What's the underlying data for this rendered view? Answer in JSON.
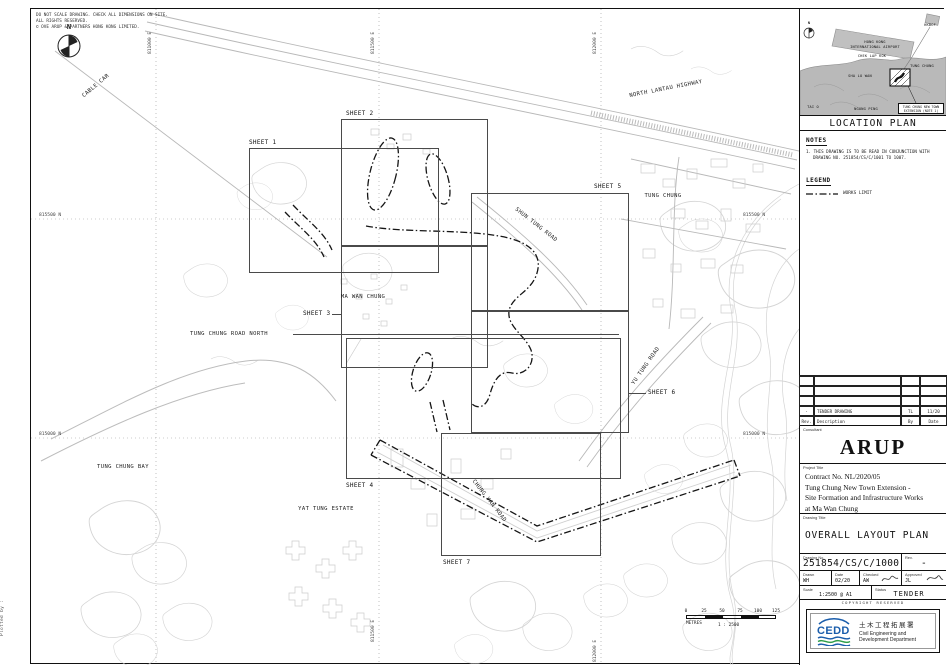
{
  "colors": {
    "cedd_blue": "#1a5dab",
    "cedd_green": "#2f9e49",
    "drawing_ink": "#1a1a1a",
    "contour_gray": "#d4d4d4"
  },
  "sheet_notes": {
    "disclaimer1": "DO NOT SCALE DRAWING. CHECK ALL DIMENSIONS ON SITE.",
    "disclaimer2": "ALL RIGHTS RESERVED.",
    "disclaimer3": "© OVE ARUP & PARTNERS HONG KONG LIMITED.",
    "plot_info": "Plotted by :"
  },
  "map": {
    "north": "N",
    "grid": {
      "e1": "811000 E",
      "e2": "811500 E",
      "e3": "812000 E",
      "n_top": "815500 N",
      "n_bottom": "815000 N"
    },
    "places": {
      "cable_car": "CABLE CAR",
      "north_lantau_highway": "NORTH LANTAU HIGHWAY",
      "tung_chung": "TUNG CHUNG",
      "shun_tung_road": "SHUN TUNG ROAD",
      "ma_wan_chung": "MA WAN CHUNG",
      "tung_chung_road_north": "TUNG CHUNG ROAD NORTH",
      "yu_tung_road": "YU TUNG ROAD",
      "tung_chung_bay": "TUNG CHUNG BAY",
      "yat_tung_estate": "YAT TUNG ESTATE",
      "chung_yan_road": "CHUNG YAN ROAD"
    },
    "sheets": {
      "s1": "SHEET 1",
      "s2": "SHEET 2",
      "s3": "SHEET 3",
      "s4": "SHEET 4",
      "s5": "SHEET 5",
      "s6": "SHEET 6",
      "s7": "SHEET 7"
    },
    "scalebar": {
      "t0": "0",
      "t1": "25",
      "t2": "50",
      "t3": "75",
      "t4": "100",
      "t5": "125",
      "unit": "METRES",
      "ratio": "1 : 2500"
    }
  },
  "location_plan": {
    "title": "LOCATION PLAN",
    "north": "N",
    "labels": {
      "airport1": "HONG KONG",
      "airport2": "INTERNATIONAL AIRPORT",
      "chek_lap_kok": "CHEK LAP KOK",
      "hkbcf": "HKBCF",
      "tung_chung": "TUNG CHUNG",
      "sha_lo_wan": "SHA LO WAN",
      "tai_o": "TAI O",
      "ngong_ping": "NGONG PING",
      "site1": "TUNG CHUNG NEW TOWN",
      "site2": "EXTENSION (NOTE 1)"
    }
  },
  "notes": {
    "heading": "NOTES",
    "line1": "1. THIS DRAWING IS TO BE READ IN CONJUNCTION WITH",
    "line2": "DRAWING NO. 251854/CS/C/1001 TO 1007."
  },
  "legend": {
    "heading": "LEGEND",
    "works_limit": "WORKS LIMIT"
  },
  "revisions": {
    "header": {
      "rev": "Rev.",
      "description": "Description",
      "by": "By",
      "date": "Date"
    },
    "row1": {
      "rev": "-",
      "description": "TENDER DRAWING",
      "by": "TL",
      "date": "11/20"
    }
  },
  "title_block": {
    "consultant_label": "Consultant",
    "consultant": "ARUP",
    "project_title_label": "Project Title",
    "project_line1": "Contract No. NL/2020/05",
    "project_line2": "Tung Chung New Town Extension -",
    "project_line3": "Site Formation and Infrastructure Works",
    "project_line4": "at Ma Wan Chung",
    "drawing_title_label": "Drawing Title",
    "drawing_title": "OVERALL LAYOUT PLAN",
    "drawing_no_label": "Drawing No.",
    "drawing_no": "251854/CS/C/1000",
    "rev_label": "Rev.",
    "rev": "-",
    "drawn_label": "Drawn",
    "drawn": "WH",
    "date_label": "Date",
    "date": "02/20",
    "checked_label": "Checked",
    "checked": "AW",
    "approved_label": "Approved",
    "approved": "JL",
    "scale_label": "Scale",
    "scale": "1:2500 @ A1",
    "status_label": "Status",
    "status": "TENDER",
    "copyright": "COPYRIGHT RESERVED"
  },
  "cedd": {
    "acronym": "CEDD",
    "name_zh": "土木工程拓展署",
    "name_en1": "Civil Engineering and",
    "name_en2": "Development Department"
  }
}
